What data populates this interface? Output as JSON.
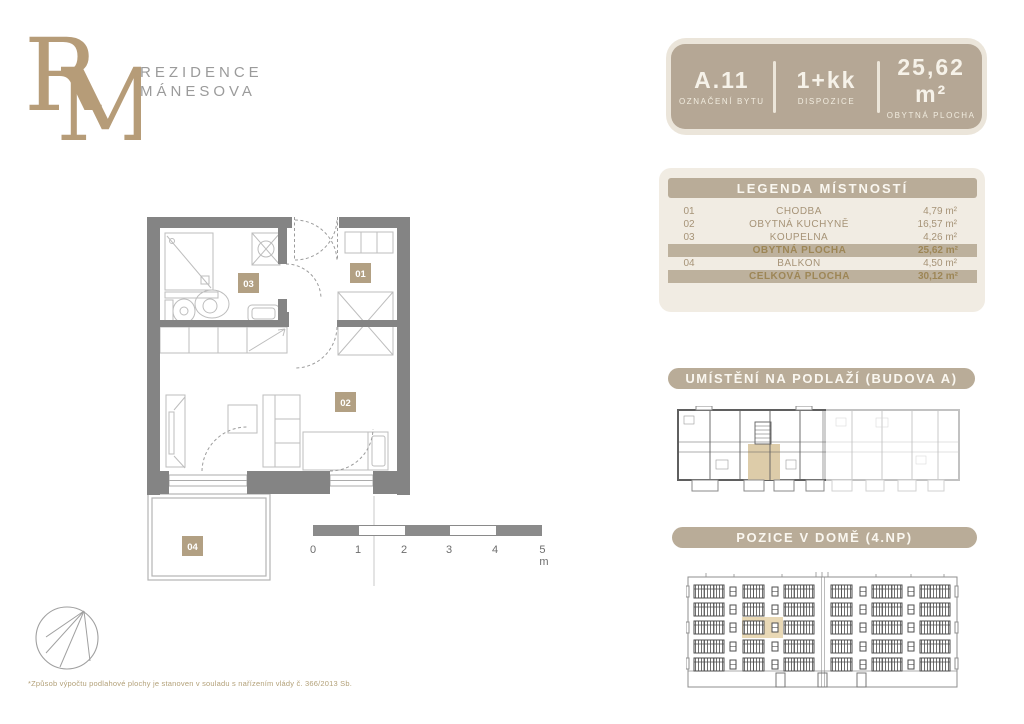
{
  "brand": {
    "monogram_r": "R",
    "monogram_m": "M",
    "name_line1": "REZIDENCE",
    "name_line2": "MÁNESOVA"
  },
  "unit_card": {
    "id": "A.11",
    "id_label": "OZNAČENÍ BYTU",
    "layout": "1+kk",
    "layout_label": "DISPOZICE",
    "area": "25,62 m²",
    "area_label": "OBYTNÁ PLOCHA"
  },
  "legend": {
    "title": "LEGENDA MÍSTNOSTÍ",
    "rows": [
      {
        "num": "01",
        "name": "CHODBA",
        "area": "4,79 m²"
      },
      {
        "num": "02",
        "name": "OBYTNÁ KUCHYNĚ",
        "area": "16,57 m²"
      },
      {
        "num": "03",
        "name": "KOUPELNA",
        "area": "4,26 m²"
      }
    ],
    "subtotal": {
      "name": "OBYTNÁ PLOCHA",
      "area": "25,62 m²"
    },
    "row_balkon": {
      "num": "04",
      "name": "BALKON",
      "area": "4,50 m²"
    },
    "total": {
      "name": "CELKOVÁ PLOCHA",
      "area": "30,12 m²"
    }
  },
  "sections": {
    "floor_location": "UMÍSTĚNÍ NA PODLAŽÍ (BUDOVA A)",
    "house_position": "POZICE V DOMĚ (4.NP)"
  },
  "plan": {
    "room_labels": {
      "r01": "01",
      "r02": "02",
      "r03": "03",
      "r04": "04"
    }
  },
  "scale_bar": {
    "labels": [
      "0",
      "1",
      "2",
      "3",
      "4",
      "5 m"
    ]
  },
  "footnote": "*Způsob výpočtu podlahové plochy je stanoven v souladu s nařízením vlády č. 366/2013 Sb.",
  "colors": {
    "brand_tan": "#b5a795",
    "bar_tan": "#b9ac98",
    "panel_cream": "#f1ece3",
    "gold_text": "#9d8656",
    "highlight": "#e9d9b6",
    "wall_gray": "#848484"
  }
}
